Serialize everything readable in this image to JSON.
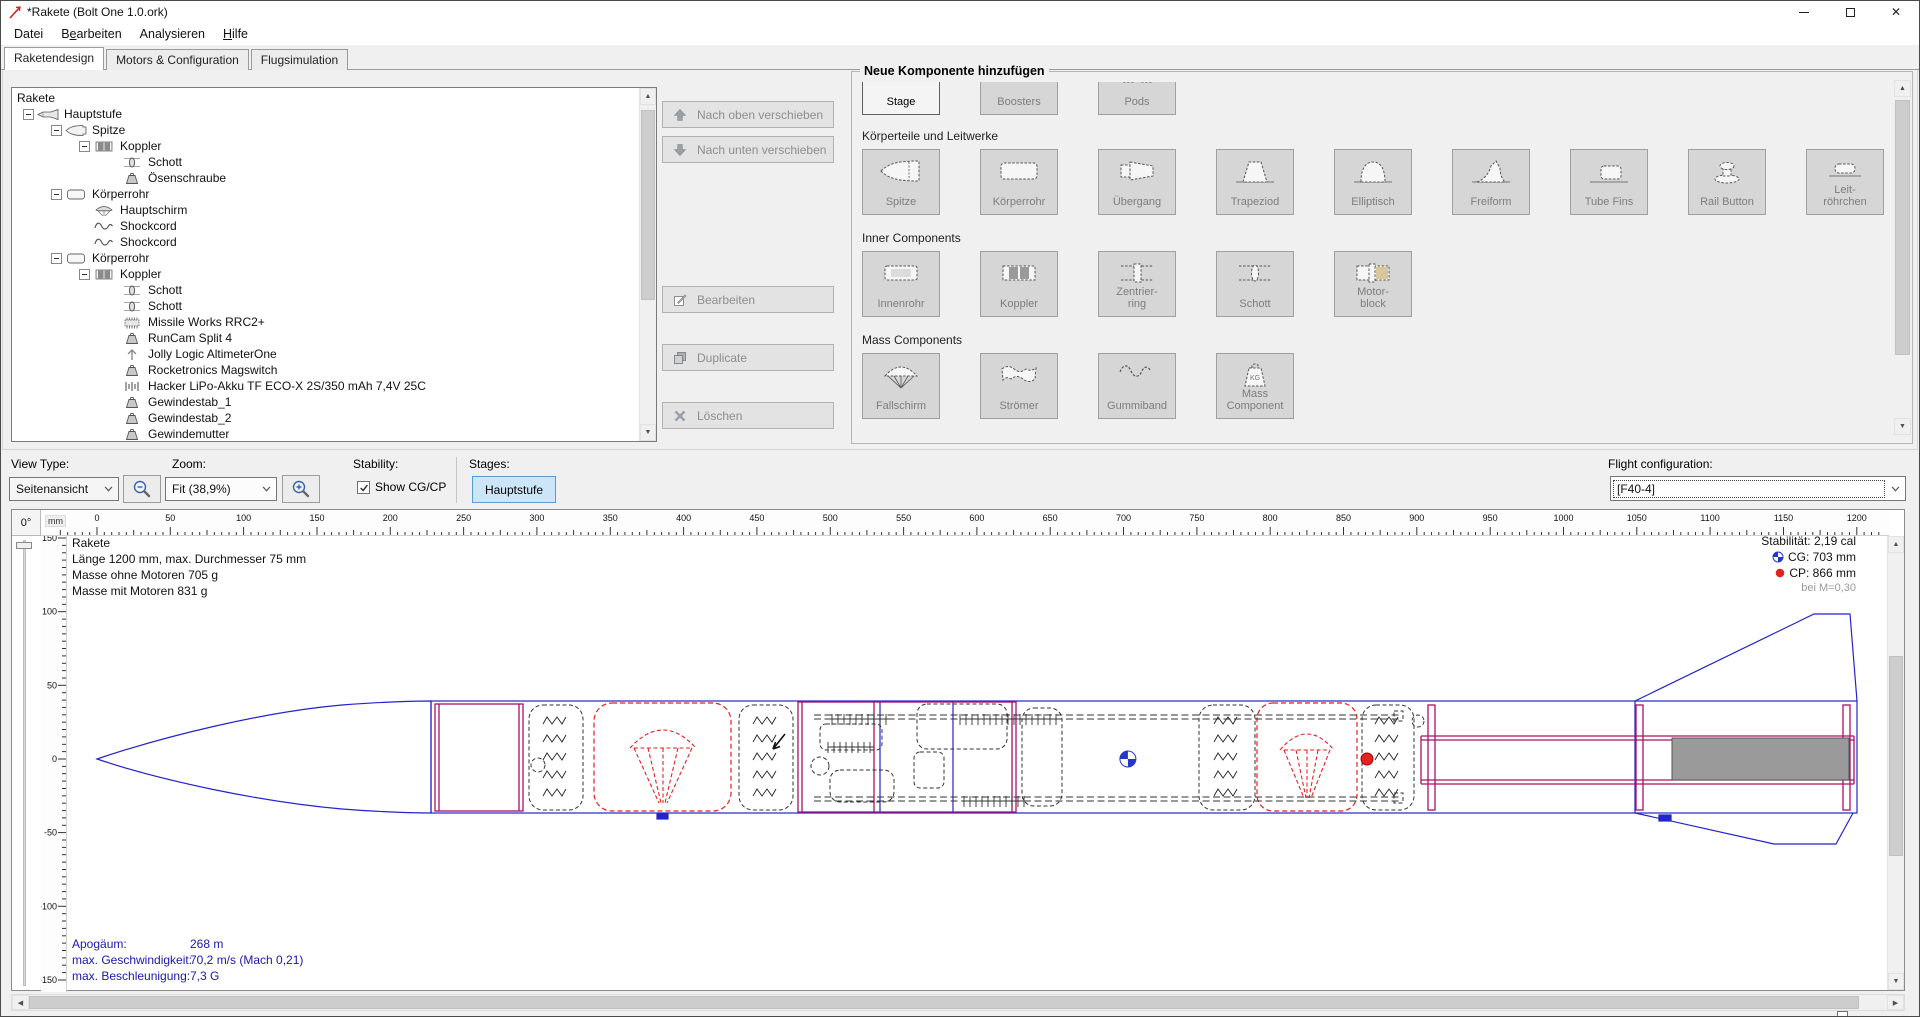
{
  "window": {
    "title": "*Rakete (Bolt One 1.0.ork)"
  },
  "menu": [
    {
      "label": "Datei",
      "u": -1
    },
    {
      "label": "Bearbeiten",
      "u": 1
    },
    {
      "label": "Analysieren",
      "u": -1
    },
    {
      "label": "Hilfe",
      "u": 0
    }
  ],
  "tabs": [
    {
      "label": "Raketendesign",
      "selected": true
    },
    {
      "label": "Motors & Configuration",
      "selected": false
    },
    {
      "label": "Flugsimulation",
      "selected": false
    }
  ],
  "tree": {
    "root": "Rakete",
    "items": [
      {
        "label": "Hauptstufe",
        "depth": 1,
        "icon": "rocket",
        "expander": true
      },
      {
        "label": "Spitze",
        "depth": 2,
        "icon": "nosecone",
        "expander": true
      },
      {
        "label": "Koppler",
        "depth": 3,
        "icon": "coupler",
        "expander": true
      },
      {
        "label": "Schott",
        "depth": 4,
        "icon": "bulkhead",
        "expander": false
      },
      {
        "label": "Ösenschraube",
        "depth": 4,
        "icon": "mass",
        "expander": false
      },
      {
        "label": "Körperrohr",
        "depth": 2,
        "icon": "bodytube",
        "expander": true
      },
      {
        "label": "Hauptschirm",
        "depth": 3,
        "icon": "parachute",
        "expander": false
      },
      {
        "label": "Shockcord",
        "depth": 3,
        "icon": "shockcord",
        "expander": false
      },
      {
        "label": "Shockcord",
        "depth": 3,
        "icon": "shockcord",
        "expander": false
      },
      {
        "label": "Körperrohr",
        "depth": 2,
        "icon": "bodytube",
        "expander": true
      },
      {
        "label": "Koppler",
        "depth": 3,
        "icon": "coupler",
        "expander": true
      },
      {
        "label": "Schott",
        "depth": 4,
        "icon": "bulkhead",
        "expander": false
      },
      {
        "label": "Schott",
        "depth": 4,
        "icon": "bulkhead",
        "expander": false
      },
      {
        "label": "Missile Works RRC2+",
        "depth": 4,
        "icon": "chip",
        "expander": false
      },
      {
        "label": "RunCam Split 4",
        "depth": 4,
        "icon": "mass",
        "expander": false
      },
      {
        "label": "Jolly Logic AltimeterOne",
        "depth": 4,
        "icon": "arrowup",
        "expander": false
      },
      {
        "label": "Rocketronics Magswitch",
        "depth": 4,
        "icon": "mass",
        "expander": false
      },
      {
        "label": "Hacker LiPo-Akku TF ECO-X 2S/350 mAh 7,4V 25C",
        "depth": 4,
        "icon": "battery",
        "expander": false
      },
      {
        "label": "Gewindestab_1",
        "depth": 4,
        "icon": "mass",
        "expander": false
      },
      {
        "label": "Gewindestab_2",
        "depth": 4,
        "icon": "mass",
        "expander": false
      },
      {
        "label": "Gewindemutter",
        "depth": 4,
        "icon": "mass",
        "expander": false
      },
      {
        "label": "",
        "depth": 4,
        "icon": "mass",
        "expander": false
      }
    ]
  },
  "actions": [
    {
      "label": "Nach oben verschieben",
      "icon": "up"
    },
    {
      "label": "Nach unten verschieben",
      "icon": "down"
    },
    {
      "label": "Bearbeiten",
      "icon": "edit"
    },
    {
      "label": "Duplicate",
      "icon": "duplicate"
    },
    {
      "label": "Löschen",
      "icon": "delete"
    }
  ],
  "add_panel": {
    "title": "Neue Komponente hinzufügen",
    "sections": [
      {
        "label": "",
        "buttons": [
          {
            "label": "Stage",
            "icon": "stage",
            "enabled": true
          },
          {
            "label": "Boosters",
            "icon": "boosters",
            "enabled": false
          },
          {
            "label": "Pods",
            "icon": "pods",
            "enabled": false
          }
        ]
      },
      {
        "label": "Körperteile und Leitwerke",
        "buttons": [
          {
            "label": "Spitze",
            "icon": "spitze",
            "enabled": false
          },
          {
            "label": "Körperrohr",
            "icon": "koerperrohr",
            "enabled": false
          },
          {
            "label": "Übergang",
            "icon": "uebergang",
            "enabled": false
          },
          {
            "label": "Trapeziod",
            "icon": "trapez",
            "enabled": false
          },
          {
            "label": "Elliptisch",
            "icon": "ellip",
            "enabled": false
          },
          {
            "label": "Freiform",
            "icon": "frei",
            "enabled": false
          },
          {
            "label": "Tube Fins",
            "icon": "tubefins",
            "enabled": false
          },
          {
            "label": "Rail Button",
            "icon": "railbutton",
            "enabled": false
          },
          {
            "label": "Leit-\nröhrchen",
            "icon": "leitr",
            "enabled": false
          }
        ]
      },
      {
        "label": "Inner Components",
        "buttons": [
          {
            "label": "Innenrohr",
            "icon": "innenrohr",
            "enabled": false
          },
          {
            "label": "Koppler",
            "icon": "kopplerP",
            "enabled": false
          },
          {
            "label": "Zentrier-\nring",
            "icon": "zring",
            "enabled": false
          },
          {
            "label": "Schott",
            "icon": "schottP",
            "enabled": false
          },
          {
            "label": "Motor-\nblock",
            "icon": "mblock",
            "enabled": false
          }
        ]
      },
      {
        "label": "Mass Components",
        "buttons": [
          {
            "label": "Fallschirm",
            "icon": "fallsch",
            "enabled": false
          },
          {
            "label": "Strömer",
            "icon": "stroem",
            "enabled": false
          },
          {
            "label": "Gummiband",
            "icon": "gummi",
            "enabled": false
          },
          {
            "label": "Mass\nComponent",
            "icon": "massP",
            "enabled": false
          }
        ]
      }
    ]
  },
  "toolbar": {
    "view_type_label": "View Type:",
    "view_type_value": "Seitenansicht",
    "zoom_label": "Zoom:",
    "zoom_value": "Fit (38,9%)",
    "stability_label": "Stability:",
    "show_cgcp": "Show CG/CP",
    "show_cgcp_checked": true,
    "stages_label": "Stages:",
    "stage_button": "Hauptstufe",
    "flight_label": "Flight configuration:",
    "flight_value": "[F40-4]"
  },
  "design": {
    "angle": "0°",
    "unit": "mm",
    "info_lines": [
      "Rakete",
      "Länge 1200 mm, max. Durchmesser 75 mm",
      "Masse ohne Motoren 705 g",
      "Masse mit Motoren 831 g"
    ],
    "stability_label": "Stabilität: 2,19 cal",
    "cg_label": "CG: 703 mm",
    "cp_label": "CP: 866 mm",
    "mach_label": "bei M=0,30",
    "flight_rows": [
      {
        "label": "Apogäum:",
        "value": "268 m"
      },
      {
        "label": "max. Geschwindigkeit:",
        "value": "70,2 m/s  (Mach 0,21)"
      },
      {
        "label": "max. Beschleunigung:",
        "value": "7,3 G"
      }
    ],
    "cg_mm": 703,
    "cp_mm": 866,
    "h_ruler_max_label": 1200,
    "v_ruler_labels": [
      150,
      100,
      50,
      0,
      -50,
      -100,
      -150
    ]
  },
  "colors": {
    "draw_blue": "#2323cc",
    "draw_magenta": "#aa1166",
    "draw_red": "#e32222",
    "motor_gray": "#9a9a9a",
    "flight_text": "#1a17b0",
    "stage_toggle_bg": "#cde6f7",
    "stage_toggle_border": "#5b9bd5"
  }
}
